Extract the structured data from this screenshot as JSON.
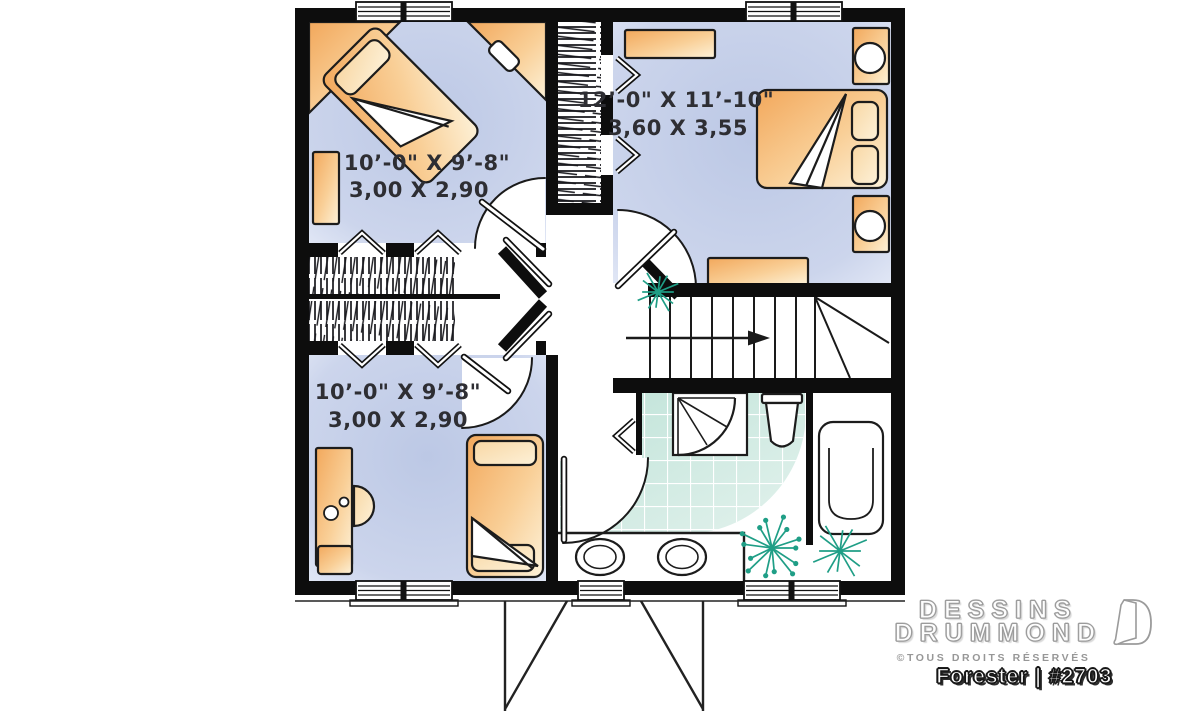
{
  "branding": {
    "name_line1": "DESSINS",
    "name_line2": "DRUMMOND",
    "rights": "©TOUS DROITS RÉSERVÉS",
    "plan_name": "Forester | #2703"
  },
  "rooms": [
    {
      "name": "bedroom-top-left",
      "dim_imperial": "10’-0\" X 9’-8\"",
      "dim_metric": "3,00 X 2,90"
    },
    {
      "name": "bedroom-master",
      "dim_imperial": "12’-0\" X 11’-10\"",
      "dim_metric": "3,60 X 3,55"
    },
    {
      "name": "bedroom-bottom-left",
      "dim_imperial": "10’-0\" X 9’-8\"",
      "dim_metric": "3,00 X 2,90"
    }
  ],
  "colors": {
    "wall": "#0d0d0d",
    "floor_blue": "#c7d2ea",
    "furniture_orange": "#f5bb74",
    "bath_tile": "#cfe8e0",
    "plant_green": "#1f9e86",
    "label_ink": "#2e2e33"
  }
}
